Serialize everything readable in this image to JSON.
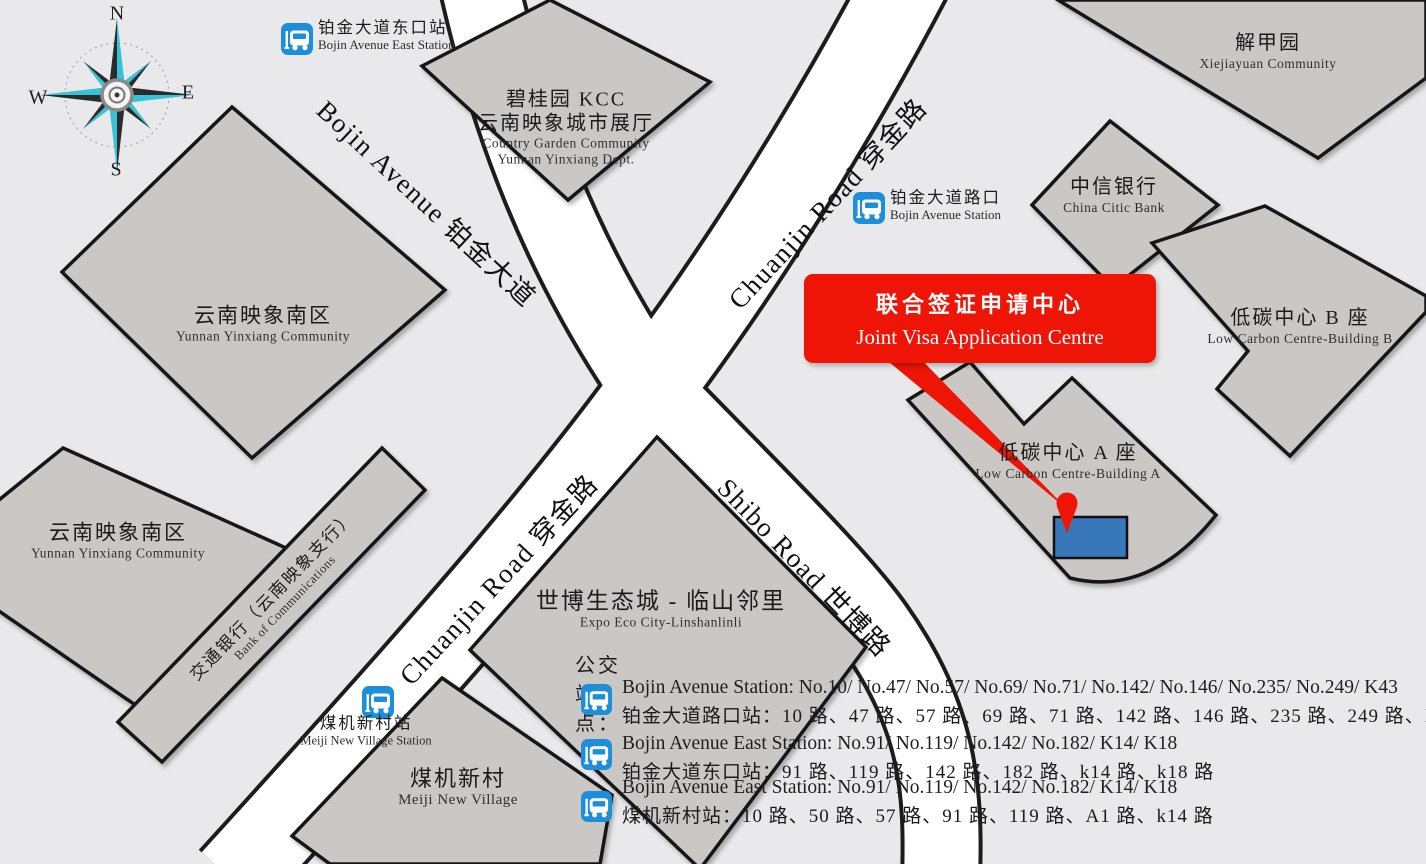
{
  "colors": {
    "background": "#e9e9ec",
    "road_fill": "#ffffff",
    "road_border": "#1c1c1c",
    "building_fill": "#cbc7c4",
    "banner_red": "#ee1506",
    "marker_blue": "#3878ba",
    "bus_icon_blue": "#1d8ed9",
    "compass_cyan": "#35c3d8"
  },
  "compass": {
    "north": "N",
    "south": "S",
    "east": "E",
    "west": "W"
  },
  "roads": {
    "bojin": {
      "label": "Bojin Avenue 铂金大道"
    },
    "chuanjin_upper": {
      "label": "Chuanjin Road 穿金路"
    },
    "chuanjin_lower": {
      "label": "Chuanjin Road 穿金路"
    },
    "shibo": {
      "label": "Shibo Road 世博路"
    }
  },
  "buildings": {
    "country_garden": {
      "zh1": "碧桂园 KCC",
      "zh2": "云南映象城市展厅",
      "en1": "Country Garden Community",
      "en2": "Yunnan Yinxiang Dept."
    },
    "xiejiayuan": {
      "zh": "解甲园",
      "en": "Xiejiayuan Community"
    },
    "citic": {
      "zh": "中信银行",
      "en": "China Citic Bank"
    },
    "low_carbon_b": {
      "zh": "低碳中心 B 座",
      "en": "Low Carbon Centre-Building B"
    },
    "low_carbon_a": {
      "zh": "低碳中心 A 座",
      "en": "Low Carbon Centre-Building A"
    },
    "yunnan_north": {
      "zh": "云南映象南区",
      "en": "Yunnan Yinxiang Community"
    },
    "yunnan_south": {
      "zh": "云南映象南区",
      "en": "Yunnan Yinxiang Community"
    },
    "bocom": {
      "zh": "交通银行（云南映象支行）",
      "en": "Bank of Communications"
    },
    "expo": {
      "zh": "世博生态城 - 临山邻里",
      "en": "Expo Eco City-Linshanlinli"
    },
    "meiji": {
      "zh": "煤机新村",
      "en": "Meiji New Village"
    }
  },
  "stations": {
    "bojin_east": {
      "zh": "铂金大道东口站",
      "en": "Bojin Avenue East Station"
    },
    "bojin": {
      "zh": "铂金大道路口",
      "en": "Bojin Avenue Station"
    },
    "meiji": {
      "zh": "煤机新村站",
      "en": "Meiji New Village Station"
    }
  },
  "destination": {
    "zh": "联合签证申请中心",
    "en": "Joint Visa Application Centre"
  },
  "bus_listing": {
    "heading": "公交站点：",
    "rows": [
      {
        "en": "Bojin Avenue Station: No.10/ No.47/ No.57/ No.69/ No.71/ No.142/ No.146/ No.235/ No.249/ K43",
        "zh": "铂金大道路口站：10 路、47 路、57 路、69 路、71 路、142 路、146 路、235 路、249 路、K43 路"
      },
      {
        "en": "Bojin Avenue East Station: No.91/ No.119/ No.142/ No.182/ K14/ K18",
        "zh": "铂金大道东口站：91 路、119 路、142 路、182 路、k14 路、k18 路"
      },
      {
        "en": "Bojin Avenue East Station: No.91/ No.119/ No.142/ No.182/ K14/ K18",
        "zh": "煤机新村站：10 路、50 路、57 路、91 路、119 路、A1 路、k14 路"
      }
    ]
  }
}
